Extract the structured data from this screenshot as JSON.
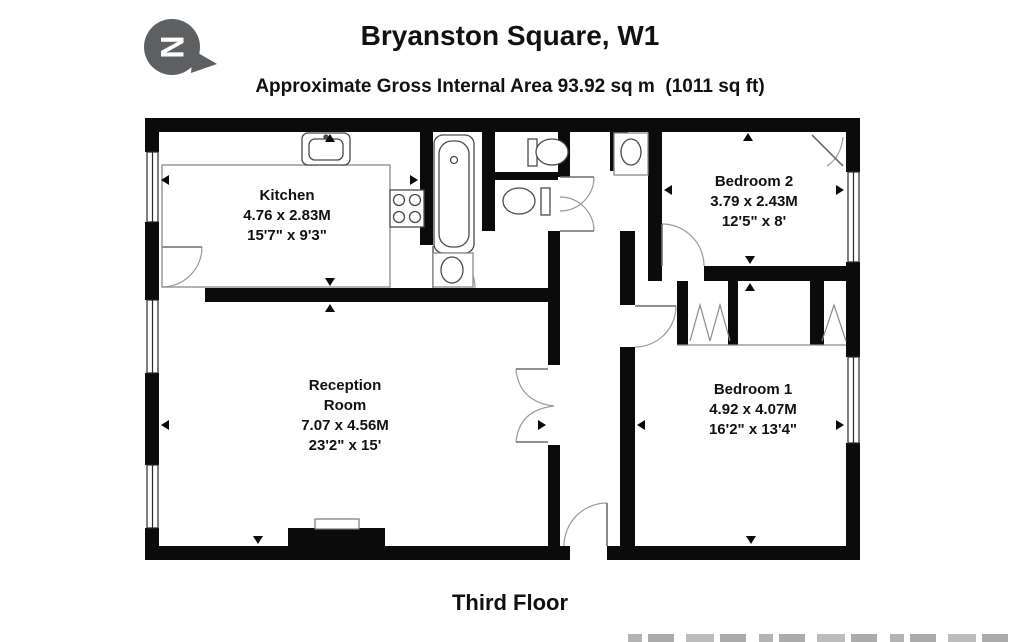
{
  "header": {
    "title": "Bryanston Square, W1",
    "subtitle": "Approximate Gross Internal Area 93.92 sq m  (1011 sq ft)",
    "north_label": "N"
  },
  "rooms": {
    "kitchen": {
      "name": "Kitchen",
      "metric": "4.76 x 2.83M",
      "imperial": "15'7\" x 9'3\""
    },
    "reception": {
      "name_line1": "Reception",
      "name_line2": "Room",
      "metric": "7.07 x 4.56M",
      "imperial": "23'2\" x 15'"
    },
    "bedroom2": {
      "name": "Bedroom 2",
      "metric": "3.79 x 2.43M",
      "imperial": "12'5\" x 8'"
    },
    "bedroom1": {
      "name": "Bedroom 1",
      "metric": "4.92 x 4.07M",
      "imperial": "16'2\" x 13'4\""
    }
  },
  "footer": {
    "floor_label": "Third Floor"
  },
  "icons": {
    "north_arrow": "compass-north-arrow",
    "fixtures": [
      "kitchen-sink",
      "hob",
      "bathtub",
      "basin",
      "toilet",
      "toilet",
      "basin",
      "fireplace",
      "wardrobe"
    ]
  },
  "colors": {
    "wall": "#0b0b0b",
    "logo_gray": "#5e5f61",
    "door_arc": "#9a9a9a",
    "fixture_line": "#4a4a4a",
    "text": "#111111"
  }
}
